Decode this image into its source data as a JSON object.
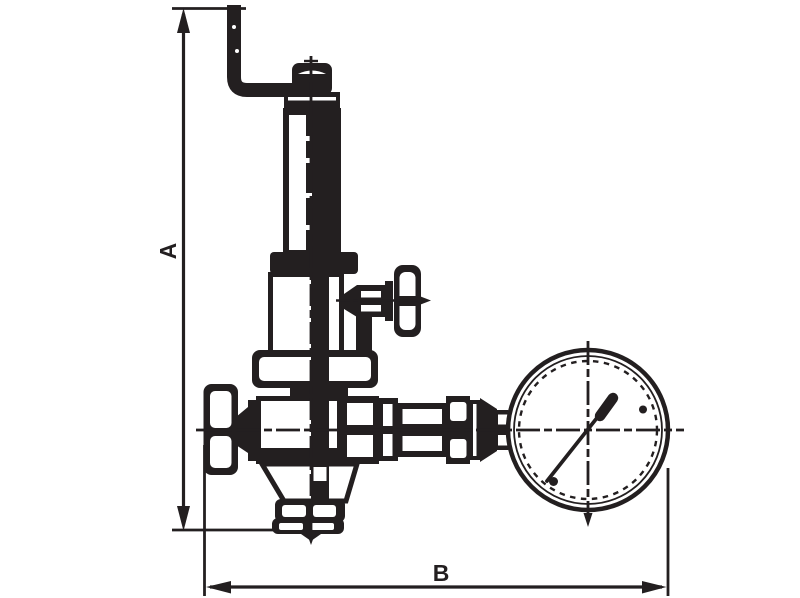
{
  "labels": {
    "dim_height": "A",
    "dim_width": "B"
  },
  "colors": {
    "line": "#231f20",
    "background": "#ffffff"
  }
}
